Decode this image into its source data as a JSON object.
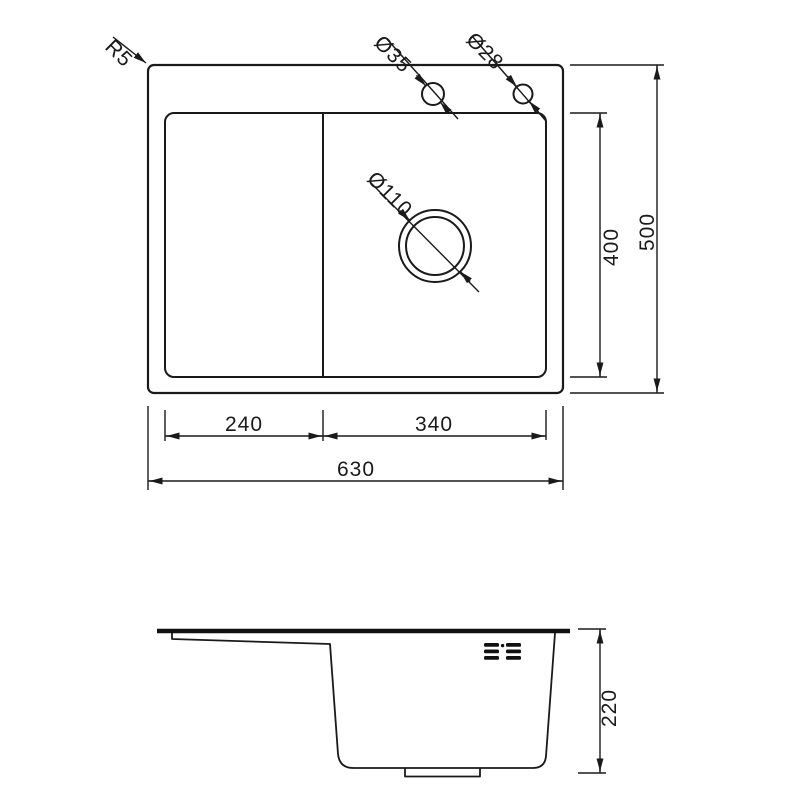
{
  "top_view": {
    "corner_radius_label": "R5",
    "faucet_hole_left_label": "Ø35",
    "faucet_hole_right_label": "Ø28",
    "drain_label": "Ø110",
    "dim_left_section_width": "240",
    "dim_right_section_width": "340",
    "dim_total_width": "630",
    "dim_inner_depth": "400",
    "dim_total_depth": "500"
  },
  "side_view": {
    "dim_bowl_depth": "220"
  },
  "colors": {
    "line": "#1a1a1a",
    "background": "#ffffff"
  }
}
